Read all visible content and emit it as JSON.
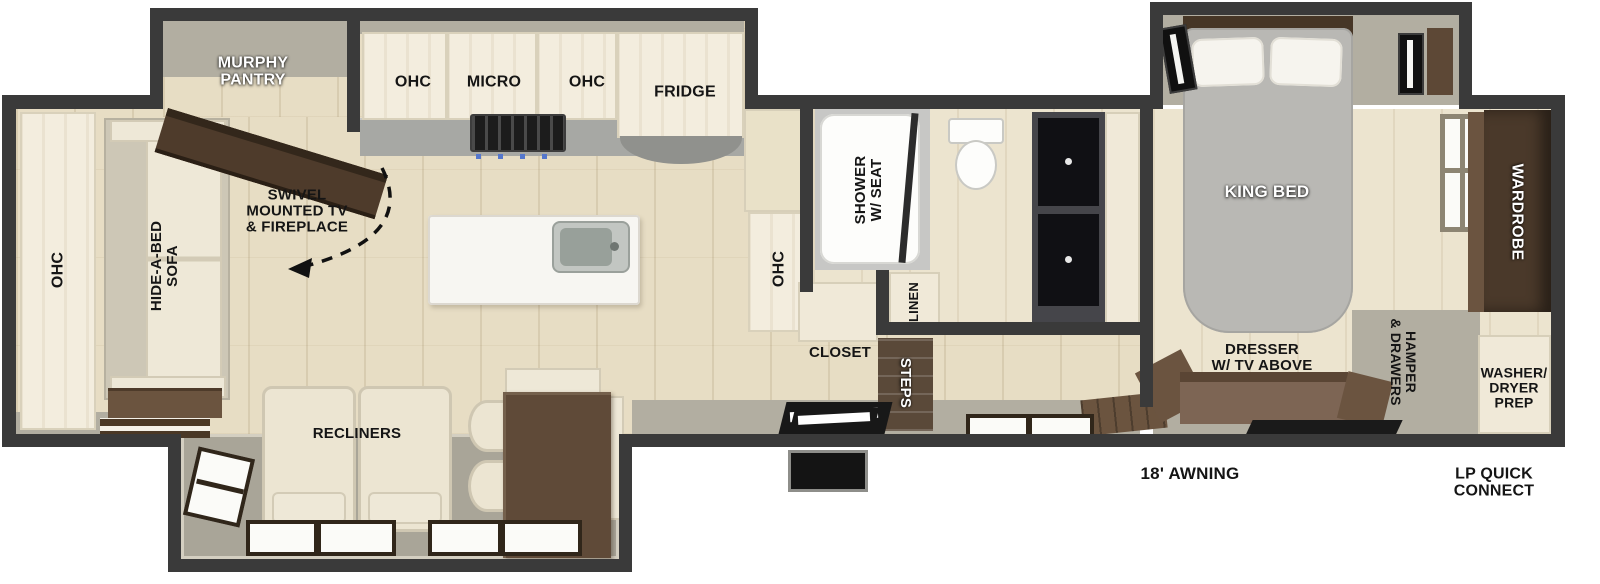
{
  "title": "Travel trailer floor plan",
  "labels": {
    "murphy_pantry": "MURPHY\nPANTRY",
    "ohc": "OHC",
    "micro": "MICRO",
    "fridge": "FRIDGE",
    "swivel_note": "SWIVEL\nMOUNTED TV\n& FIREPLACE",
    "hide_a_bed": "HIDE-A-BED\nSOFA",
    "recliners": "RECLINERS",
    "shower": "SHOWER\nW/ SEAT",
    "linen": "LINEN",
    "closet": "CLOSET",
    "steps": "STEPS",
    "king_bed": "KING BED",
    "wardrobe": "WARDROBE",
    "dresser": "DRESSER\nW/ TV ABOVE",
    "hamper": "HAMPER\n& DRAWERS",
    "washer": "WASHER/\nDRYER\nPREP",
    "awning": "18' AWNING",
    "lp_quick_connect": "LP QUICK\nCONNECT"
  },
  "colors": {
    "wall": "#3a3a3a",
    "floor_wood": "#e7ddc4",
    "cabinet_cream": "#f1ebdb",
    "slide_gray": "#b2aea1",
    "furniture_brown": "#5d4836",
    "bed_gray": "#b9b8b4"
  }
}
